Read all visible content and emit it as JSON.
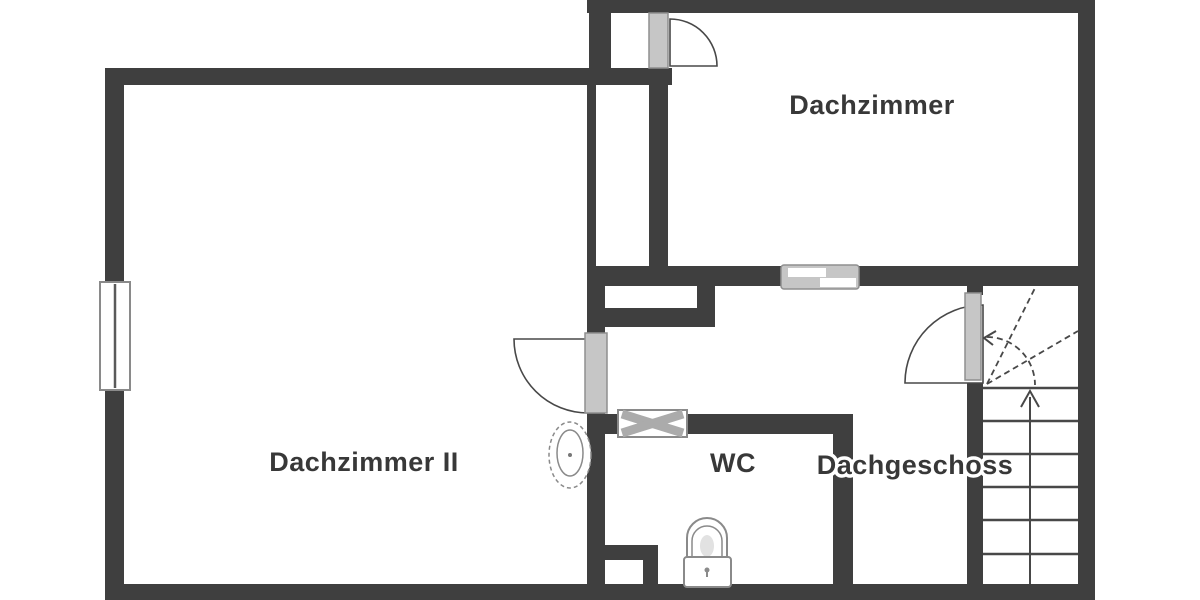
{
  "plan": {
    "title": "Dachgeschoss Grundriss",
    "floor_label": "Dachgeschoss",
    "rooms": [
      {
        "id": "dachzimmer",
        "label": "Dachzimmer"
      },
      {
        "id": "dachzimmer-ii",
        "label": "Dachzimmer II"
      },
      {
        "id": "wc",
        "label": "WC"
      },
      {
        "id": "dachgeschoss",
        "label": "Dachgeschoss"
      }
    ],
    "fixtures": [
      {
        "name": "toilet-icon",
        "room": "WC"
      },
      {
        "name": "sink-icon",
        "room": "Dachzimmer II"
      },
      {
        "name": "staircase",
        "room": "Dachgeschoss",
        "treads": 6,
        "direction_arrow": "up"
      },
      {
        "name": "window",
        "wall": "left exterior"
      },
      {
        "name": "sliding-door",
        "wall": "Dachzimmer south"
      },
      {
        "name": "hatch-window",
        "wall": "WC north"
      },
      {
        "name": "door-swing",
        "count": 3
      }
    ]
  },
  "colors": {
    "wall": "#3f3f3f",
    "line": "#484848",
    "leaf": "#c6c6c6",
    "leaf_border": "#8f8f8f",
    "window_border": "#8a8a8a",
    "fixture": "#8a8a8a",
    "symbol": "#ababab",
    "text": "#383838",
    "background": "#ffffff"
  }
}
